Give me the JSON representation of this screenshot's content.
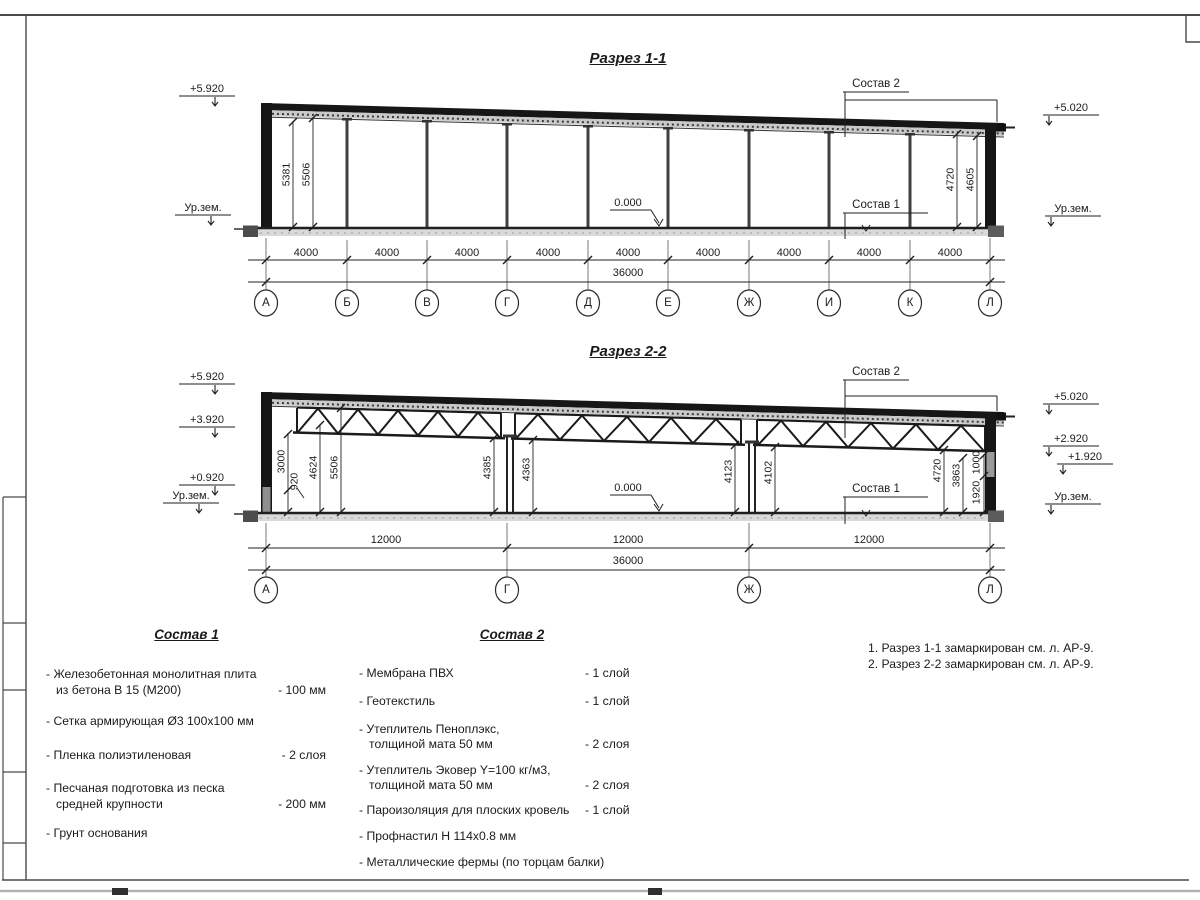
{
  "titles": {
    "section1": "Разрез 1-1",
    "section2": "Разрез 2-2"
  },
  "section1": {
    "elevations": {
      "left_top": "+5.920",
      "left_ground": "Ур.зем.",
      "right_top": "+5.020",
      "right_ground": "Ур.зем."
    },
    "datum": "0.000",
    "callouts": {
      "top": "Состав 2",
      "bottom": "Состав 1"
    },
    "vdims": {
      "left1": "5381",
      "left2": "5506",
      "right1": "4720",
      "right2": "4605"
    },
    "bays": [
      "4000",
      "4000",
      "4000",
      "4000",
      "4000",
      "4000",
      "4000",
      "4000",
      "4000"
    ],
    "total": "36000",
    "grid": [
      "А",
      "Б",
      "В",
      "Г",
      "Д",
      "Е",
      "Ж",
      "И",
      "К",
      "Л"
    ]
  },
  "section2": {
    "elevations": {
      "left1": "+5.920",
      "left2": "+3.920",
      "left3": "+0.920",
      "left_ground": "Ур.зем.",
      "right1": "+5.020",
      "right2": "+2.920",
      "right3": "+1.920",
      "right_ground": "Ур.зем."
    },
    "datum": "0.000",
    "callouts": {
      "top": "Состав 2",
      "bottom": "Состав 1"
    },
    "vdims": {
      "d3000": "3000",
      "d920": "920",
      "d4624": "4624",
      "d5506": "5506",
      "d4385": "4385",
      "d4363": "4363",
      "d4123": "4123",
      "d4102": "4102",
      "d4720": "4720",
      "d3863": "3863",
      "d1000": "1000",
      "d1920": "1920"
    },
    "bays": [
      "12000",
      "12000",
      "12000"
    ],
    "total": "36000",
    "grid": [
      "А",
      "Г",
      "Ж",
      "Л"
    ]
  },
  "legend1": {
    "title": "Состав 1",
    "items": [
      {
        "line1": "- Железобетонная  монолитная плита",
        "line2": "из бетона В 15 (М200)",
        "qty": "- 100 мм"
      },
      {
        "line1": "- Сетка армирующая Ø3 100x100 мм",
        "line2": "",
        "qty": ""
      },
      {
        "line1": "- Пленка полиэтиленовая",
        "line2": "",
        "qty": "-  2 слоя"
      },
      {
        "line1": "- Песчаная подготовка из песка",
        "line2": "средней крупности",
        "qty": "- 200 мм"
      },
      {
        "line1": "- Грунт основания",
        "line2": "",
        "qty": ""
      }
    ]
  },
  "legend2": {
    "title": "Состав 2",
    "items": [
      {
        "line1": "- Мембрана ПВХ",
        "line2": "",
        "qty": "- 1 слой"
      },
      {
        "line1": "- Геотекстиль",
        "line2": "",
        "qty": "- 1 слой"
      },
      {
        "line1": "- Утеплитель Пеноплэкс,",
        "line2": "толщиной мата 50 мм",
        "qty": "- 2 слоя"
      },
      {
        "line1": "- Утеплитель Эковер Y=100 кг/м3,",
        "line2": "толщиной мата 50 мм",
        "qty": "- 2 слоя"
      },
      {
        "line1": "- Пароизоляция для плоских кровель",
        "line2": "",
        "qty": "- 1 слой"
      },
      {
        "line1": "- Профнастил Н 114x0.8 мм",
        "line2": "",
        "qty": ""
      },
      {
        "line1": "- Металлические фермы (по торцам балки)",
        "line2": "",
        "qty": ""
      }
    ]
  },
  "notes": {
    "line1": "1. Разрез 1-1 замаркирован см. л. АР-9.",
    "line2": "2. Разрез 2-2 замаркирован см. л. АР-9."
  }
}
